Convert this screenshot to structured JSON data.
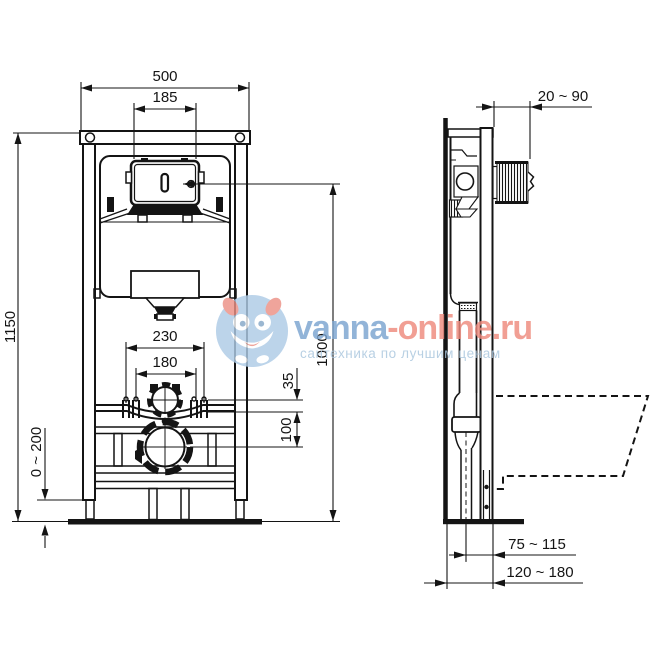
{
  "drawing": {
    "line_color": "#141414",
    "front_view": {
      "dim_width": "500",
      "dim_plate_width": "185",
      "dim_frame_height": "1150",
      "dim_actuator_height": "1000",
      "dim_bolt_outer": "230",
      "dim_bolt_inner": "180",
      "dim_inlet_offset": "35",
      "dim_drain_offset": "100",
      "dim_feet_range": "0 ~ 200"
    },
    "side_view": {
      "dim_plate_depth_range": "20 ~ 90",
      "dim_drain_front_range": "75 ~ 115",
      "dim_frame_depth_range": "120 ~ 180"
    }
  },
  "watermark": {
    "brand_primary": "vanna",
    "brand_secondary": "-online.ru",
    "tagline": "сантехника по лучшим ценам",
    "color_primary": "#7ba4d0",
    "color_secondary": "#ee8a7d",
    "color_tagline": "#a9c6de",
    "logo_color": "#aecbe6",
    "logo_accent": "#ec9186"
  }
}
